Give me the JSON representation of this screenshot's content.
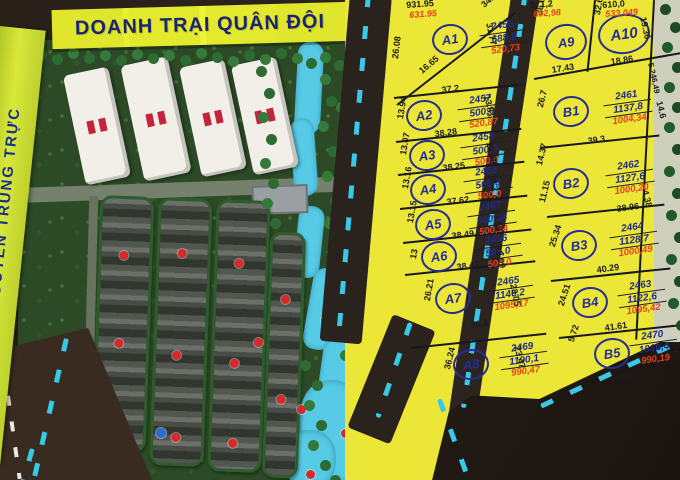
{
  "banner": {
    "military_camp": "DOANH TRẠI QUÂN ĐỘI"
  },
  "street": {
    "name": "ĐƯỜNG NGUYỄN TRUNG TRỰC"
  },
  "colors": {
    "plot_yellow": "#ece636",
    "banner_yellow": "#e3ea2e",
    "road_dark": "#2a221c",
    "lane_dash_cyan": "#38c8e8",
    "navy_text": "#1f2a8c",
    "red_text": "#e8401c",
    "model_green": "#2c4a26",
    "river_blue": "#57cbe6",
    "marker_red": "#d62a2a"
  },
  "plots": {
    "A1": {
      "label": "A1",
      "num": "2456",
      "area": "688,8",
      "red": "520,73"
    },
    "A2": {
      "label": "A2",
      "num": "2457",
      "area": "500,0",
      "red": "520,87"
    },
    "A3": {
      "label": "A3",
      "num": "2458",
      "area": "500,0",
      "red": "500,0"
    },
    "A4": {
      "label": "A4",
      "num": "2468",
      "area": "500,0",
      "red": "500,0"
    },
    "A5": {
      "label": "A5",
      "num": "2467",
      "area": "500,34",
      "red": "500,34"
    },
    "A6": {
      "label": "A6",
      "num": "2466",
      "area": "500,0",
      "red": "500,0"
    },
    "A7": {
      "label": "A7",
      "num": "2465",
      "area": "1146,2",
      "red": "1095,17"
    },
    "A8": {
      "label": "A8",
      "num": "2469",
      "area": "1190,1",
      "red": "990,47"
    },
    "A9": {
      "label": "A9"
    },
    "A10": {
      "label": "A10"
    },
    "B1": {
      "label": "B1",
      "num": "2461",
      "area": "1137,8",
      "red": "1004,34"
    },
    "B2": {
      "label": "B2",
      "num": "2462",
      "area": "1127,6",
      "red": "1000,20"
    },
    "B3": {
      "label": "B3",
      "num": "2464",
      "area": "1128,7",
      "red": "1000,49"
    },
    "B4": {
      "label": "B4",
      "num": "2463",
      "area": "1122,6",
      "red": "1095,42"
    },
    "B5": {
      "label": "B5",
      "num": "2470",
      "area": "1016,4",
      "red": "990,19"
    }
  },
  "dims": [
    "931.95",
    "631.95",
    "34.21",
    "31.77",
    "26.08",
    "16.65",
    "37.2",
    "13.94",
    "38.28",
    "13.81",
    "13.07",
    "38.25",
    "13.08",
    "13.16",
    "37.62",
    "13.2",
    "13.15",
    "38.49",
    "13.19",
    "13",
    "38.43",
    "12.99",
    "26.21",
    "36.4",
    "23.05",
    "36.24",
    "23.47",
    "36.6",
    "17.43",
    "32.66",
    "18.86",
    "19.36",
    "26.7",
    "39.3",
    "14.6",
    "14.37",
    "11.15",
    "38.96",
    "4.38",
    "25.34",
    "40.29",
    "24.51",
    "41.61",
    "5.72",
    "52.97",
    "5.246,49",
    "571,2",
    "602,98",
    "610,0",
    "533,049"
  ]
}
